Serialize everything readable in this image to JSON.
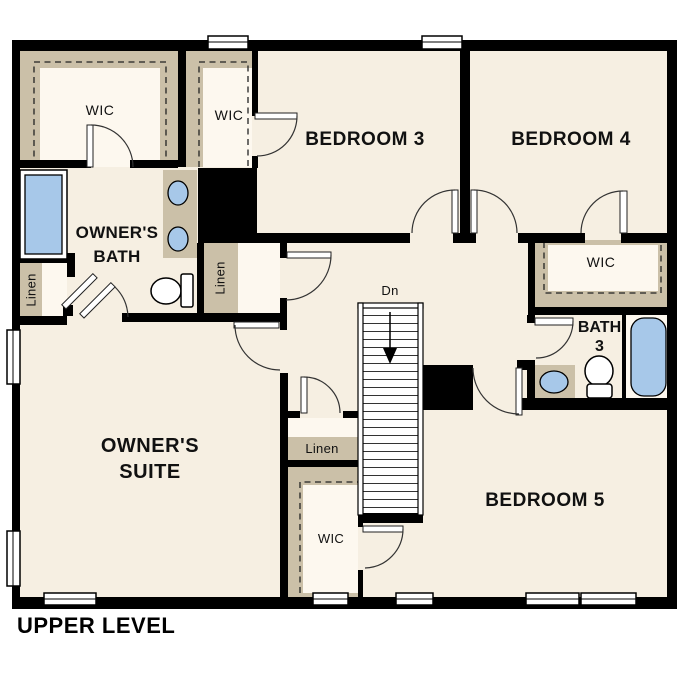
{
  "title": "UPPER LEVEL",
  "labels": {
    "bedroom3": "BEDROOM 3",
    "bedroom4": "BEDROOM 4",
    "bedroom5": "BEDROOM 5",
    "owners_suite_1": "OWNER'S",
    "owners_suite_2": "SUITE",
    "owners_bath_1": "OWNER'S",
    "owners_bath_2": "BATH",
    "bath3_1": "BATH",
    "bath3_2": "3",
    "wic_owner": "WIC",
    "wic_hall": "WIC",
    "wic_bedroom4": "WIC",
    "wic_bedroom5": "WIC",
    "linen_bath": "Linen",
    "linen_hall": "Linen",
    "linen_lower": "Linen",
    "stairs_down": "Dn"
  },
  "colors": {
    "floor": "#f6efe2",
    "shelf": "#cbc0a8",
    "blue": "#a7c8e9",
    "wall": "#000000"
  }
}
